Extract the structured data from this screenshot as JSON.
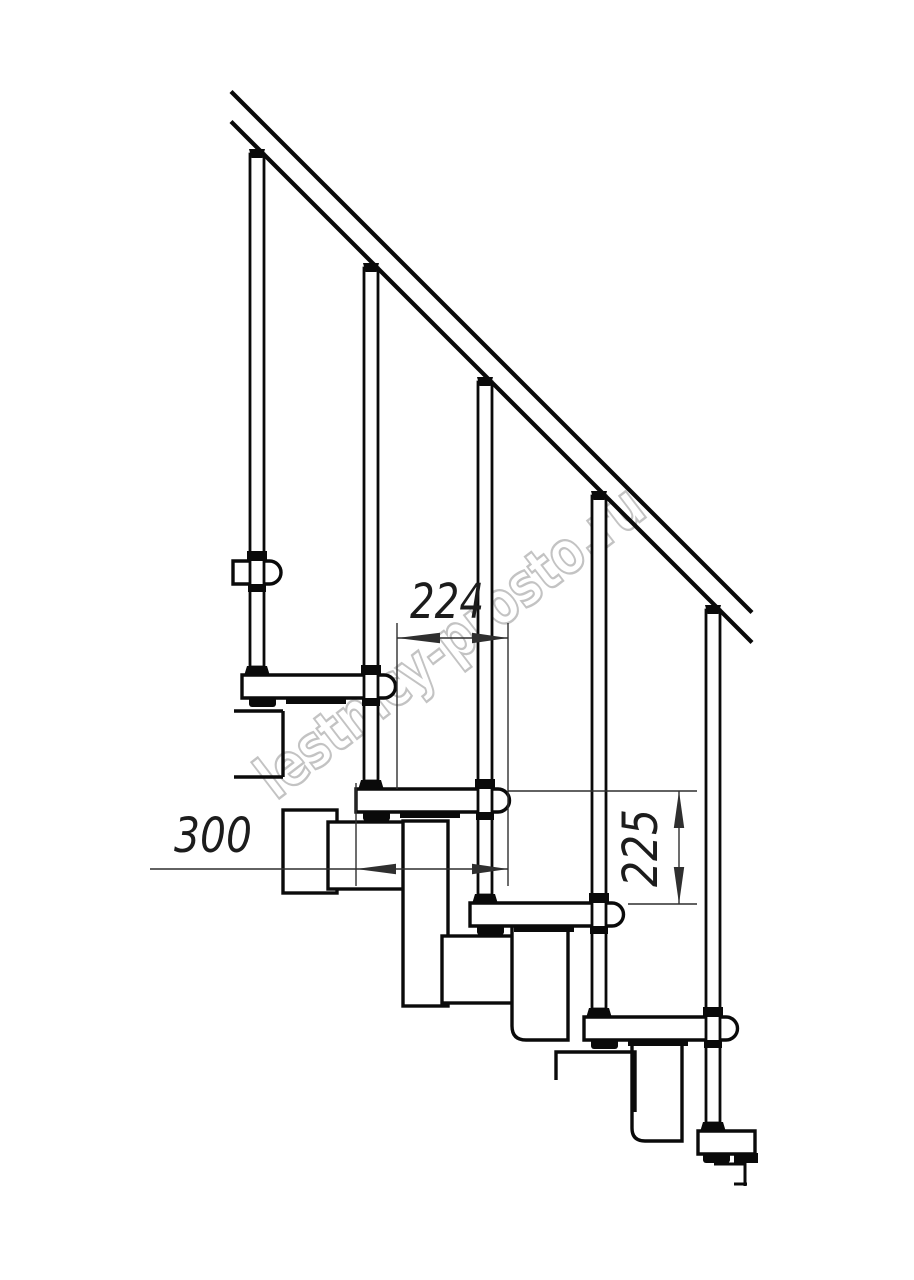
{
  "drawing": {
    "watermark_text": "lestnicy-prosto.ru",
    "dimensions": {
      "step_run_mm": "224",
      "tread_depth_mm": "300",
      "riser_height_mm": "225"
    },
    "colors": {
      "background": "#ffffff",
      "line": "#0a0a0a",
      "dimension": "#2f2f2f",
      "watermark": "#c3c3c3"
    }
  }
}
